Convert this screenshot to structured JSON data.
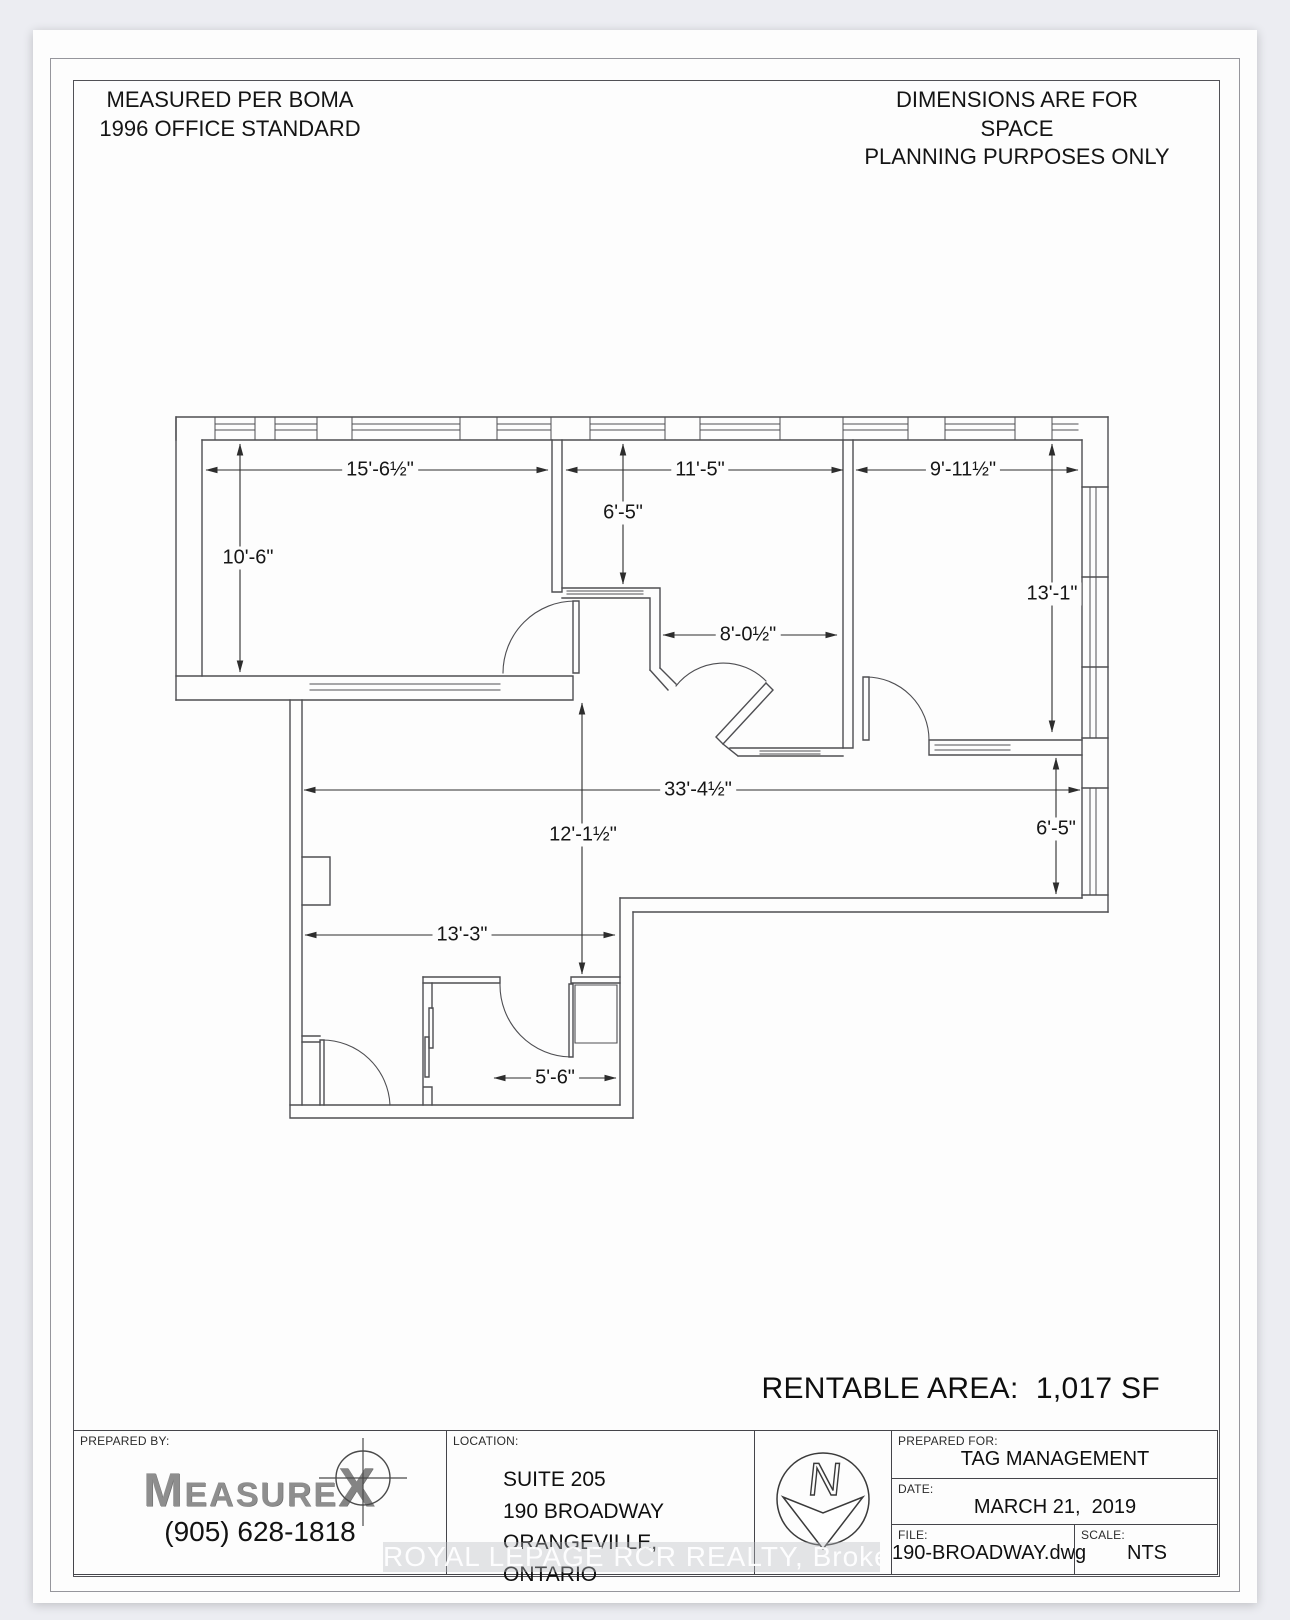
{
  "notes": {
    "top_left_1": "MEASURED PER BOMA",
    "top_left_2": "1996 OFFICE STANDARD",
    "top_right_1": "DIMENSIONS ARE FOR SPACE",
    "top_right_2": "PLANNING PURPOSES ONLY"
  },
  "plan": {
    "dims": [
      {
        "label": "15'-6½\"",
        "x": 380,
        "y": 470
      },
      {
        "label": "11'-5\"",
        "x": 700,
        "y": 470
      },
      {
        "label": "9'-11½\"",
        "x": 963,
        "y": 470
      },
      {
        "label": "6'-5\"",
        "x": 623,
        "y": 513
      },
      {
        "label": "10'-6\"",
        "x": 248,
        "y": 558
      },
      {
        "label": "13'-1\"",
        "x": 1052,
        "y": 594
      },
      {
        "label": "8'-0½\"",
        "x": 748,
        "y": 635
      },
      {
        "label": "33'-4½\"",
        "x": 698,
        "y": 790
      },
      {
        "label": "12'-1½\"",
        "x": 583,
        "y": 835
      },
      {
        "label": "6'-5\"",
        "x": 1056,
        "y": 829
      },
      {
        "label": "13'-3\"",
        "x": 462,
        "y": 935
      },
      {
        "label": "5'-6\"",
        "x": 555,
        "y": 1078
      }
    ]
  },
  "rentable_area": "RENTABLE AREA:  1,017 SF",
  "watermark": "ROYAL LEPAGE RCR REALTY, Brokerage",
  "title_block": {
    "prepared_by_label": "PREPARED BY:",
    "logo_m": "M",
    "logo_rest": "EASURE",
    "logo_x": "X",
    "phone": "(905) 628-1818",
    "location_label": "LOCATION:",
    "address_1": "SUITE 205",
    "address_2": "190 BROADWAY",
    "address_3": "ORANGEVILLE, ONTARIO",
    "north_letter": "N",
    "prepared_for_label": "PREPARED FOR:",
    "prepared_for": "TAG MANAGEMENT",
    "date_label": "DATE:",
    "date": "MARCH 21,  2019",
    "file_label": "FILE:",
    "file": "190-BROADWAY.dwg",
    "scale_label": "SCALE:",
    "scale": "NTS"
  }
}
